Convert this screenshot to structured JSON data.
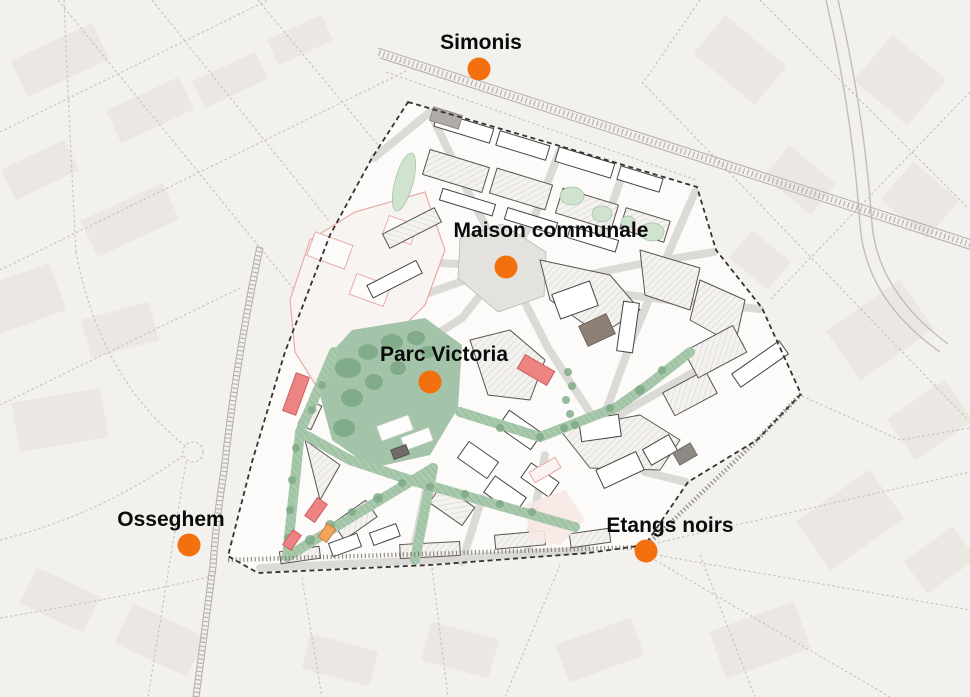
{
  "markers": [
    {
      "id": "simonis",
      "label": "Simonis"
    },
    {
      "id": "maison-communale",
      "label": "Maison communale"
    },
    {
      "id": "parc-victoria",
      "label": "Parc Victoria"
    },
    {
      "id": "osseghem",
      "label": "Osseghem"
    },
    {
      "id": "etangs-noirs",
      "label": "Etangs noirs"
    }
  ],
  "colors": {
    "marker": "#F3700E",
    "label": "#0B0B0B",
    "background": "#F3F1EE",
    "district_fill": "#FCFBF9",
    "park_green": "#A3C4A8",
    "corridor_green": "#9FC3A5",
    "accent_red": "#EE8383",
    "accent_orange": "#F2A35C",
    "boundary": "#34322F"
  }
}
